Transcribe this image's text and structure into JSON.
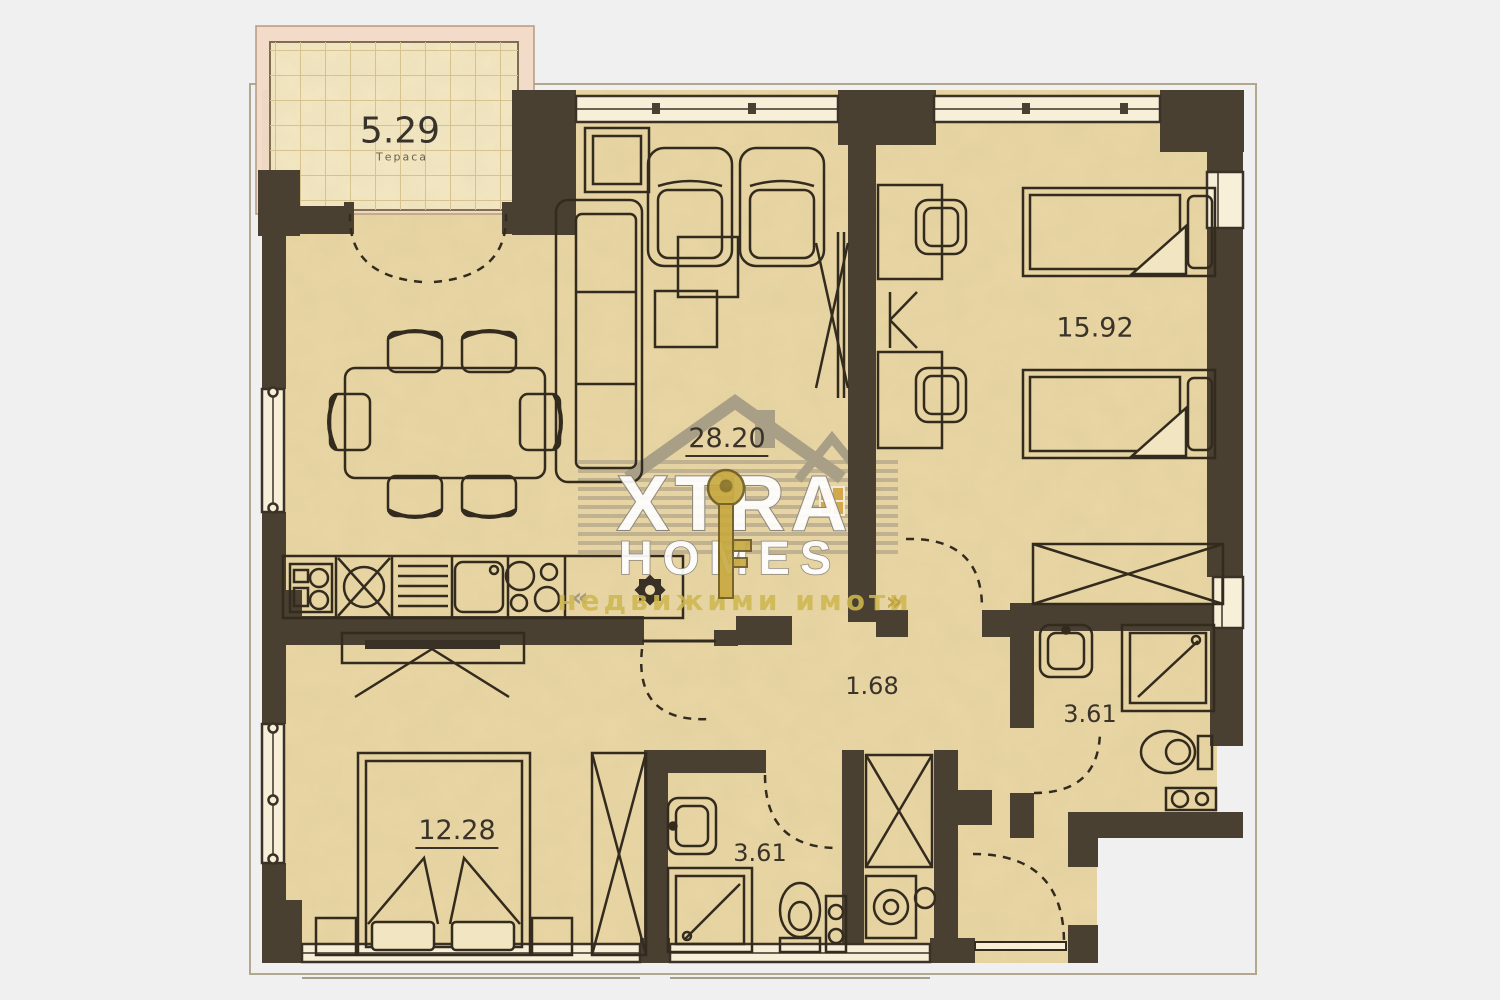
{
  "plan": {
    "title": "apartment-floor-plan",
    "watermark": {
      "brand_top": "XTRA",
      "brand_bottom": "HOMES",
      "tagline": "недвижими имоти",
      "left_mark": "«",
      "right_mark": "»"
    },
    "rooms": [
      {
        "name": "terrace",
        "area": "5.29",
        "sublabel": "Тераса"
      },
      {
        "name": "living-room",
        "area": "28.20"
      },
      {
        "name": "bedroom-right",
        "area": "15.92"
      },
      {
        "name": "corridor",
        "area": "1.68"
      },
      {
        "name": "bathroom-right",
        "area": "3.61"
      },
      {
        "name": "bedroom-left",
        "area": "12.28"
      },
      {
        "name": "bathroom-center",
        "area": "3.61"
      }
    ],
    "colors": {
      "wall": "#4a4031",
      "floor": "#e9d6a4",
      "balcony_floor": "#f4e8c4",
      "balcony_frame": "#f2dbc8",
      "outside": "#f1f0f1",
      "furniture_line": "#332b1e",
      "window_fill": "#f8efd8",
      "key_gold": "#c7a93f",
      "tagline_gold": "#cdb650",
      "label_text": "#3a332a"
    }
  }
}
